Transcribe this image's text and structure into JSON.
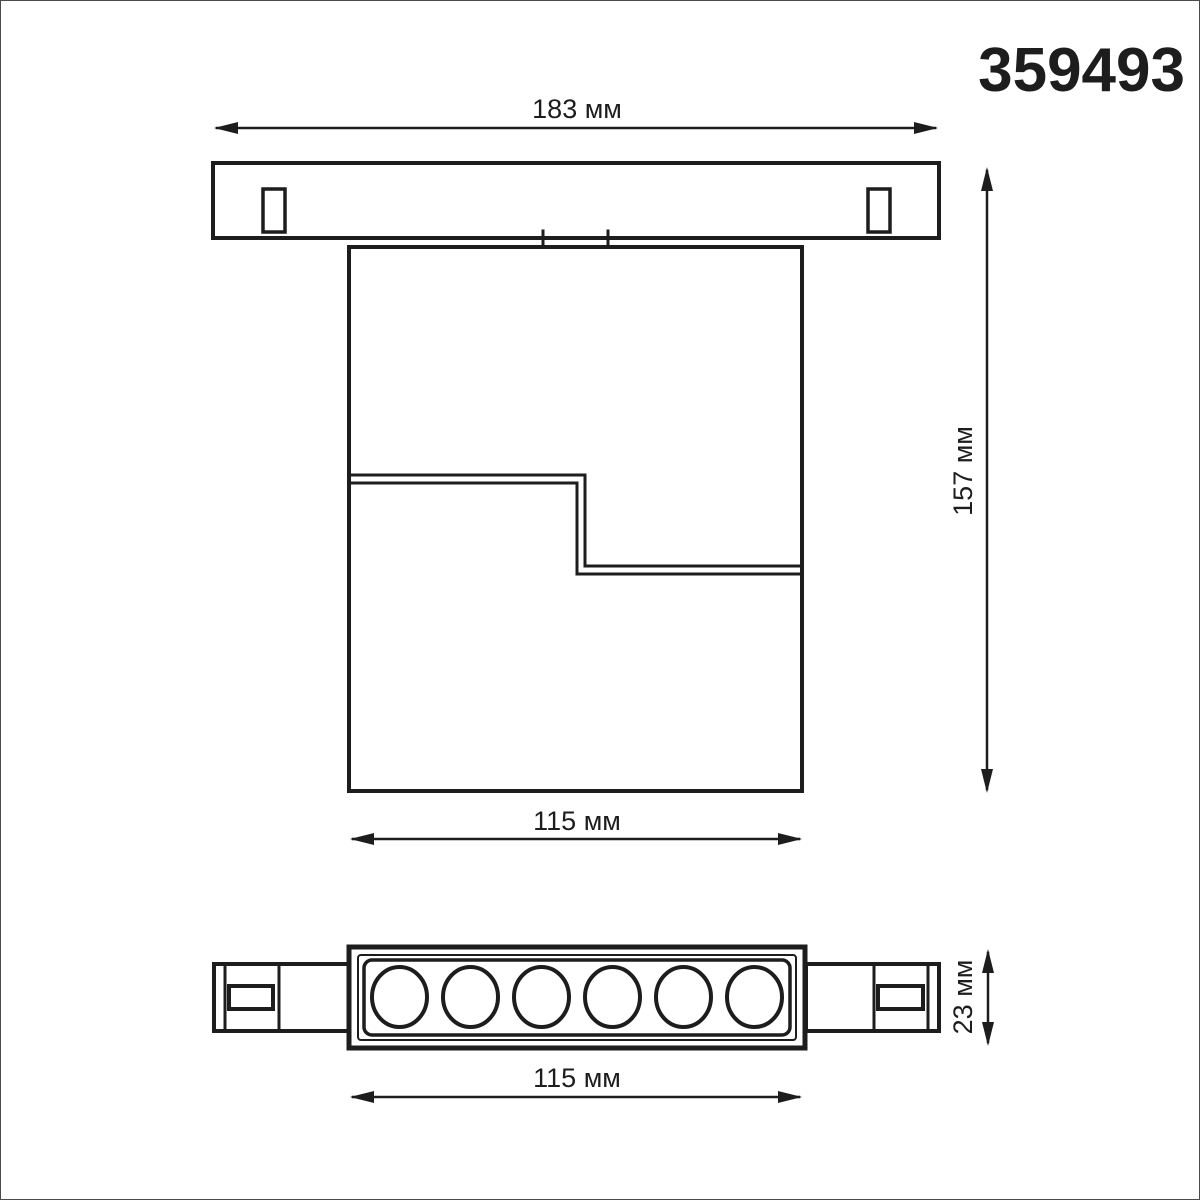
{
  "product_code": "359493",
  "colors": {
    "line": "#1d1d1d",
    "background": "#ffffff",
    "frame_border": "#4a4a4a"
  },
  "front_view": {
    "track_width": "183 мм",
    "overall_height": "157 мм",
    "body_width": "115 мм"
  },
  "bottom_view": {
    "module_width": "115 мм",
    "module_height": "23 мм",
    "led_count": 6
  }
}
